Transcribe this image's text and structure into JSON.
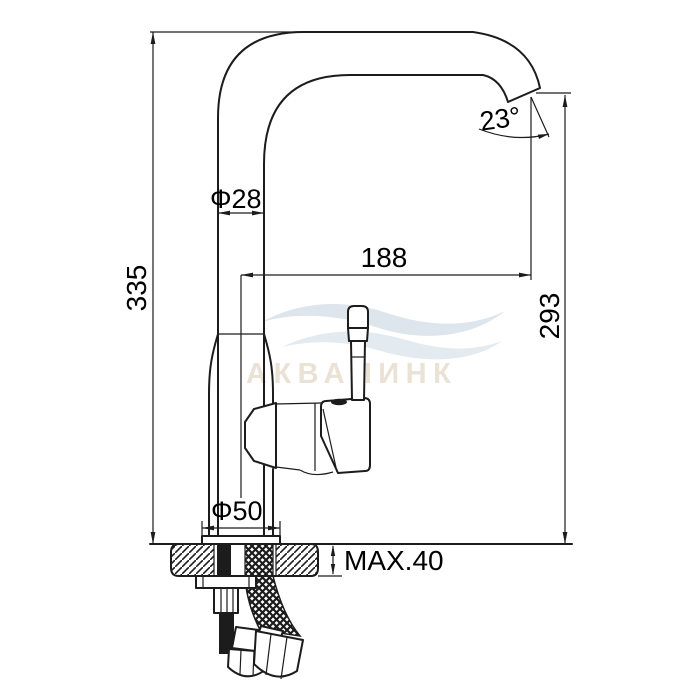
{
  "drawing": {
    "background": "#ffffff",
    "line_color": "#1c1c1c",
    "kind": "faucet installation technical drawing",
    "dimensions": {
      "total_height": "335",
      "spout_tube_diameter": "Φ28",
      "spout_reach": "188",
      "spout_outlet_angle": "23°",
      "outlet_height": "293",
      "base_diameter": "Φ50",
      "max_deck_thickness": "MAX.40"
    }
  },
  "watermark": {
    "brand_text": "АКВАЛИНК",
    "text_color": "#e9e2d5",
    "wave_color_top": "#dde5ed",
    "wave_color_bottom": "#e3eaf0"
  }
}
